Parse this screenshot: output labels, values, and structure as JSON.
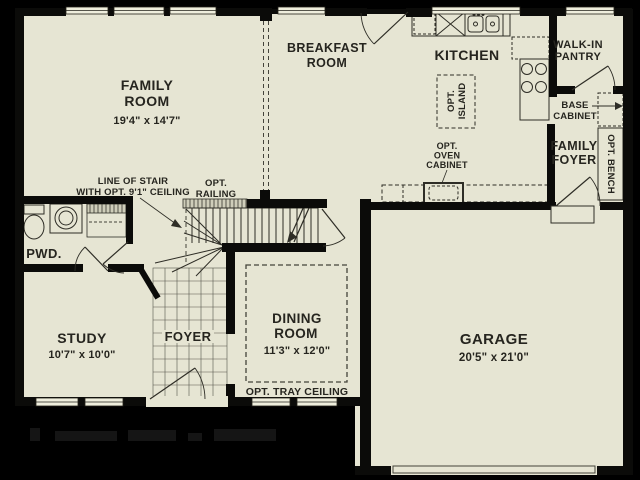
{
  "colors": {
    "background": "#000000",
    "floor": "#e6e5d3",
    "wall": "#0b0b09",
    "ink": "#26251f",
    "dash": "#44433a",
    "window_fill": "#efeedd"
  },
  "rooms": {
    "family_room": {
      "line1": "FAMILY",
      "line2": "ROOM",
      "dims": "19'4\" x 14'7\""
    },
    "breakfast_room": {
      "line1": "BREAKFAST",
      "line2": "ROOM"
    },
    "kitchen": {
      "name": "KITCHEN"
    },
    "walk_in_pantry": {
      "line1": "WALK-IN",
      "line2": "PANTRY"
    },
    "family_foyer": {
      "line1": "FAMILY",
      "line2": "FOYER"
    },
    "pwd": {
      "name": "PWD."
    },
    "study": {
      "name": "STUDY",
      "dims": "10'7\" x 10'0\""
    },
    "foyer": {
      "name": "FOYER"
    },
    "dining_room": {
      "line1": "DINING",
      "line2": "ROOM",
      "dims": "11'3\" x 12'0\""
    },
    "garage": {
      "name": "GARAGE",
      "dims": "20'5\" x 21'0\""
    }
  },
  "annotations": {
    "line_of_stair": {
      "line1": "LINE OF STAIR",
      "line2": "WITH OPT. 9'1\" CEILING"
    },
    "opt_railing": {
      "line1": "OPT.",
      "line2": "RAILING"
    },
    "opt_island": {
      "line1": "OPT.",
      "line2": "ISLAND"
    },
    "opt_oven_cabinet": {
      "line1": "OPT.",
      "line2": "OVEN",
      "line3": "CABINET"
    },
    "base_cabinet": {
      "line1": "BASE",
      "line2": "CABINET"
    },
    "opt_bench": {
      "name": "OPT. BENCH"
    },
    "opt_tray_ceiling": {
      "name": "OPT. TRAY CEILING"
    }
  }
}
